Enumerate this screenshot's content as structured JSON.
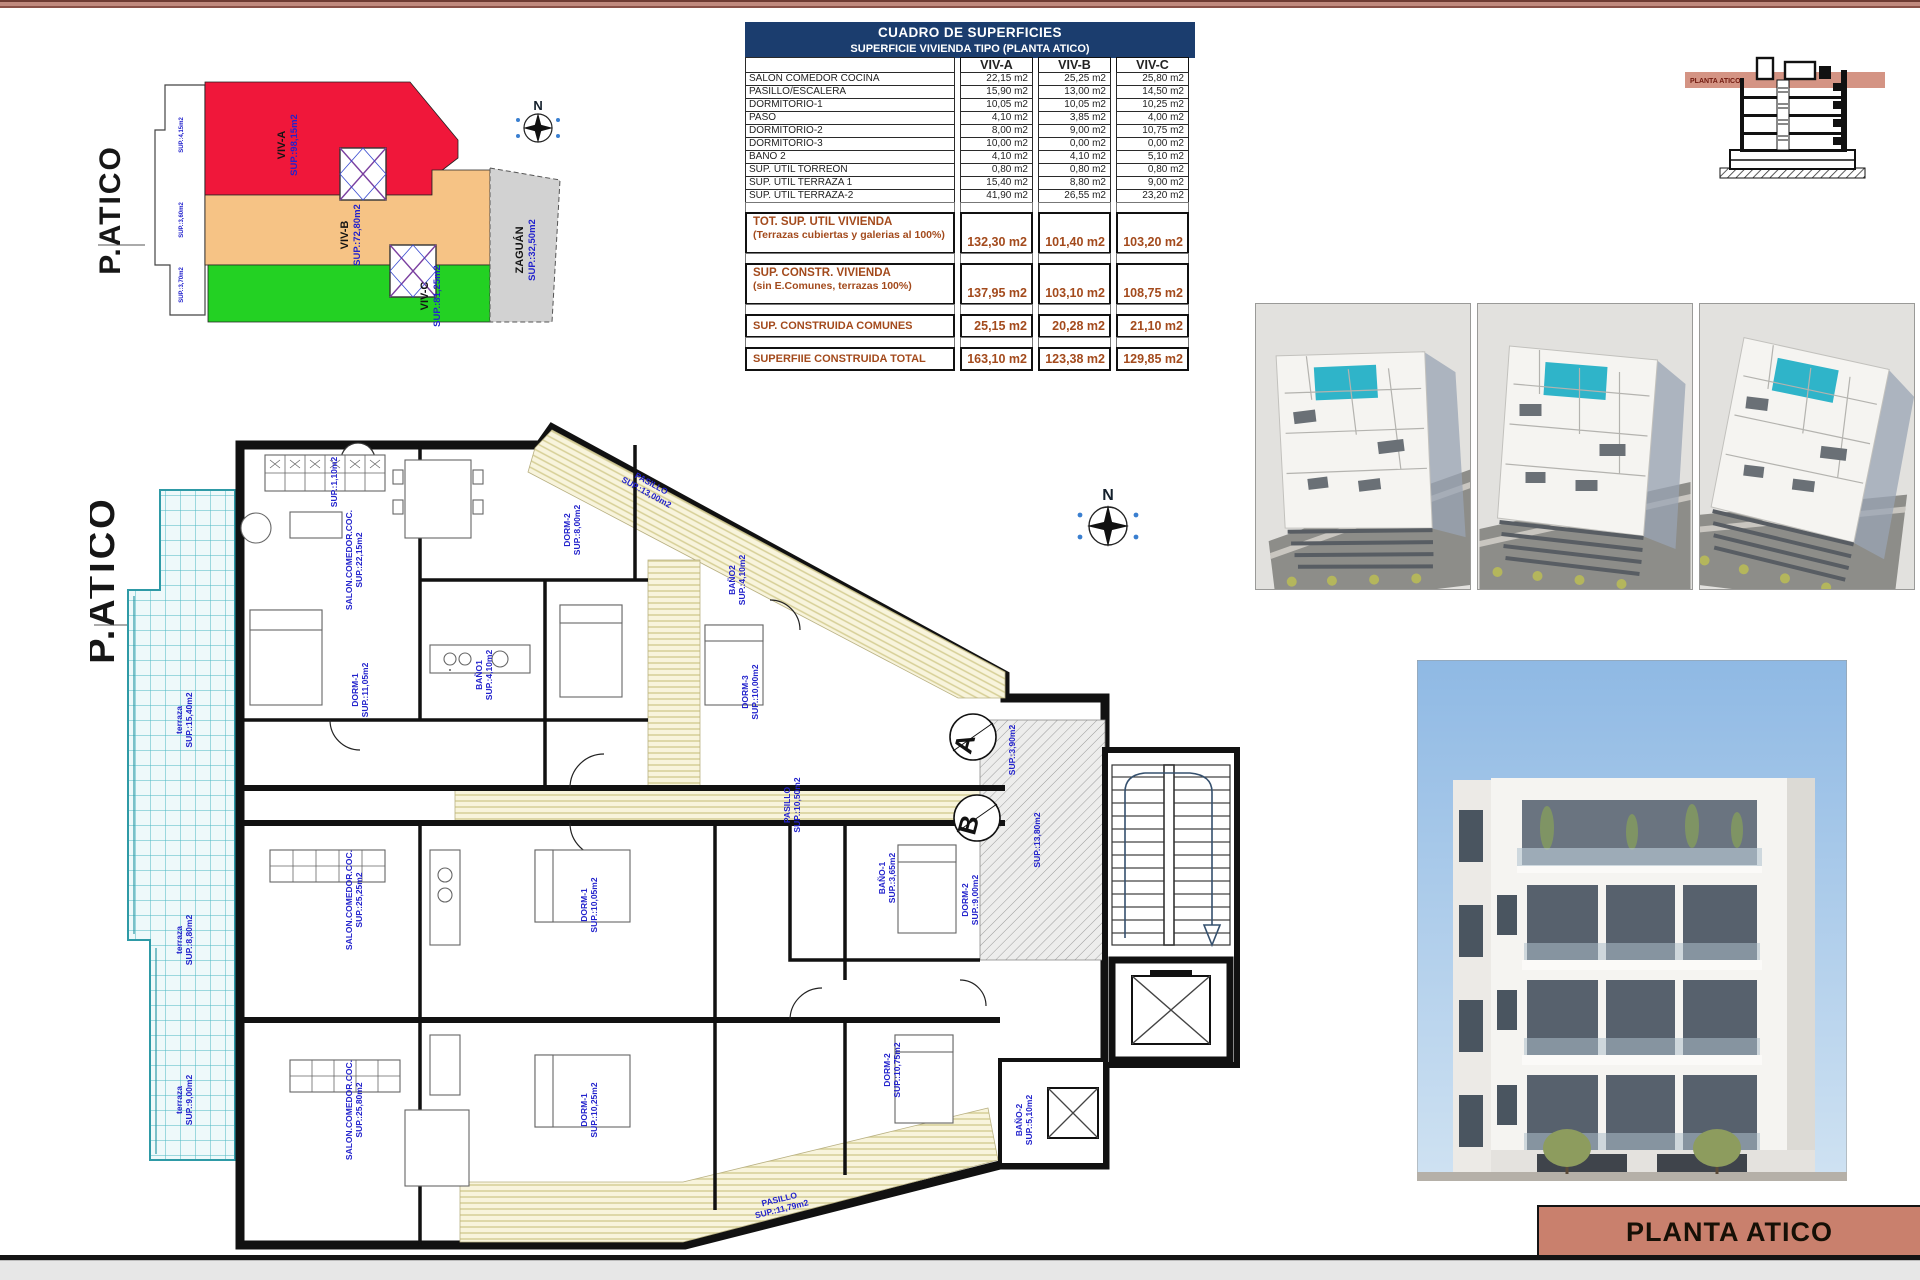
{
  "colors": {
    "navy": "#1b3d6e",
    "salmon": "#c9806d",
    "section_band": "#d08b79",
    "brown_text": "#a34a1c",
    "blue_label": "#2222cc",
    "red_zone": "#f0173a",
    "orange_zone": "#f6c385",
    "green_zone": "#23d123",
    "gray_zone": "#d2d2d2",
    "pool": "#2fb4c9",
    "tile": "#49b7c2",
    "cream": "#f8f4dc"
  },
  "table": {
    "title": "CUADRO DE SUPERFICIES",
    "subtitle": "SUPERFICIE VIVIENDA TIPO  (PLANTA ATICO)",
    "columns": [
      "VIV-A",
      "VIV-B",
      "VIV-C"
    ],
    "rows": [
      {
        "label": "SALON COMEDOR COCINA",
        "values": [
          "22,15 m2",
          "25,25 m2",
          "25,80 m2"
        ]
      },
      {
        "label": "PASILLO/ESCALERA",
        "values": [
          "15,90 m2",
          "13,00 m2",
          "14,50 m2"
        ]
      },
      {
        "label": "DORMITORIO-1",
        "values": [
          "10,05 m2",
          "10,05 m2",
          "10,25 m2"
        ]
      },
      {
        "label": "PASO",
        "values": [
          "4,10 m2",
          "3,85 m2",
          "4,00 m2"
        ]
      },
      {
        "label": "DORMITORIO-2",
        "values": [
          "8,00 m2",
          "9,00 m2",
          "10,75 m2"
        ]
      },
      {
        "label": "DORMITORIO-3",
        "values": [
          "10,00 m2",
          "0,00 m2",
          "0,00 m2"
        ]
      },
      {
        "label": "BAÑO 2",
        "values": [
          "4,10 m2",
          "4,10 m2",
          "5,10 m2"
        ]
      },
      {
        "label": "SUP. ÚTIL TORREÓN",
        "values": [
          "0,80 m2",
          "0,80 m2",
          "0,80 m2"
        ]
      },
      {
        "label": "SUP. ÚTIL TERRAZA 1",
        "values": [
          "15,40 m2",
          "8,80 m2",
          "9,00 m2"
        ]
      },
      {
        "label": "SUP. ÚTIL TERRAZA-2",
        "values": [
          "41,90 m2",
          "26,55 m2",
          "23,20 m2"
        ]
      }
    ],
    "totals": [
      {
        "label": "TOT. SUP. UTIL VIVIENDA",
        "sub": "(Terrazas cubiertas y galerias al 100%)",
        "values": [
          "132,30 m2",
          "101,40 m2",
          "103,20 m2"
        ]
      },
      {
        "label": "SUP. CONSTR. VIVIENDA",
        "sub": "(sin E.Comunes, terrazas 100%)",
        "values": [
          "137,95 m2",
          "103,10 m2",
          "108,75 m2"
        ]
      },
      {
        "label": "SUP. CONSTRUIDA COMUNES",
        "sub": "",
        "values": [
          "25,15 m2",
          "20,28 m2",
          "21,10 m2"
        ]
      },
      {
        "label": "SUPERFIIE CONSTRUIDA TOTAL",
        "sub": "",
        "values": [
          "163,10 m2",
          "123,38 m2",
          "129,85 m2"
        ]
      }
    ]
  },
  "key_plan": {
    "title": "P.ATICO",
    "compass_n": "N",
    "zones": [
      {
        "id": "viv-a",
        "name": "VIV-A",
        "sup": "SUP.:98,15m2",
        "color": "#f0173a",
        "x": 195,
        "y": 105
      },
      {
        "id": "viv-b",
        "name": "VIV-B",
        "sup": "SUP.:72,80m2",
        "color": "#f6c385",
        "x": 258,
        "y": 195
      },
      {
        "id": "viv-c",
        "name": "VIV-C",
        "sup": "SUP.:81,25m2",
        "color": "#23d123",
        "x": 338,
        "y": 256
      },
      {
        "id": "zaguan",
        "name": "ZAGUÁN",
        "sup": "SUP.:32,50m2",
        "color": "#d2d2d2",
        "x": 433,
        "y": 210
      }
    ],
    "edge_labels": [
      {
        "t": "SUP.:4,15m2",
        "x": 93,
        "y": 95
      },
      {
        "t": "SUP.:3,60m2",
        "x": 93,
        "y": 180
      },
      {
        "t": "SUP.:3,70m2",
        "x": 93,
        "y": 245
      }
    ]
  },
  "section": {
    "band_label": "PLANTA ATICO"
  },
  "floorplan": {
    "title": "P.ATICO",
    "compass_n": "N",
    "circles": [
      {
        "l": "A",
        "x": 883,
        "y": 317
      },
      {
        "l": "B",
        "x": 887,
        "y": 398
      },
      {
        "l": "C",
        "x": 973,
        "y": 664
      }
    ],
    "labels": [
      {
        "t": "terraza|SUP.:15,40m2",
        "x": 92,
        "y": 300,
        "r": -90
      },
      {
        "t": "terraza|SUP.:8,80m2",
        "x": 92,
        "y": 520,
        "r": -90
      },
      {
        "t": "terraza|SUP.:9,00m2",
        "x": 92,
        "y": 680,
        "r": -90
      },
      {
        "t": "SUP.:1,10m2",
        "x": 247,
        "y": 62,
        "r": -90
      },
      {
        "t": "SALON.COMEDOR.COC.|SUP.:22,15m2",
        "x": 262,
        "y": 140,
        "r": -90
      },
      {
        "t": "DORM-2|SUP.:8,00m2",
        "x": 480,
        "y": 110,
        "r": -90
      },
      {
        "t": "PASILLO|SUP.:13,00m2",
        "x": 560,
        "y": 66,
        "r": 29
      },
      {
        "t": "BAÑO2|SUP.:4,10m2",
        "x": 645,
        "y": 160,
        "r": -90
      },
      {
        "t": "DORM-3|SUP.:10,00m2",
        "x": 658,
        "y": 272,
        "r": -90
      },
      {
        "t": "DORM-1|SUP.:11,05m2",
        "x": 268,
        "y": 270,
        "r": -90
      },
      {
        "t": "BAÑO1|SUP.:4,10m2",
        "x": 392,
        "y": 255,
        "r": -90
      },
      {
        "t": "PASILLO|SUP.:10,50m2",
        "x": 700,
        "y": 385,
        "r": -90
      },
      {
        "t": "SALON.COMEDOR.COC.|SUP.:25,25m2",
        "x": 262,
        "y": 480,
        "r": -90
      },
      {
        "t": "DORM-1|SUP.:10,05m2",
        "x": 497,
        "y": 485,
        "r": -90
      },
      {
        "t": "BAÑO-1|SUP.:3,65m2",
        "x": 795,
        "y": 458,
        "r": -90
      },
      {
        "t": "DORM-2|SUP.:9,00m2",
        "x": 878,
        "y": 480,
        "r": -90
      },
      {
        "t": "SALON.COMEDOR.COC.|SUP.:25,80m2",
        "x": 262,
        "y": 690,
        "r": -90
      },
      {
        "t": "DORM-1|SUP.:10,25m2",
        "x": 497,
        "y": 690,
        "r": -90
      },
      {
        "t": "DORM-2|SUP.:10,75m2",
        "x": 800,
        "y": 650,
        "r": -90
      },
      {
        "t": "PASILLO|SUP.:11,79m2",
        "x": 690,
        "y": 782,
        "r": -14
      },
      {
        "t": "SUP.:13,80m2",
        "x": 950,
        "y": 420,
        "r": -90
      },
      {
        "t": "SUP.:3,90m2",
        "x": 925,
        "y": 330,
        "r": -90
      },
      {
        "t": "BAÑO-2|SUP.:5,10m2",
        "x": 932,
        "y": 700,
        "r": -90
      }
    ]
  },
  "title_block": {
    "label": "PLANTA ATICO"
  }
}
